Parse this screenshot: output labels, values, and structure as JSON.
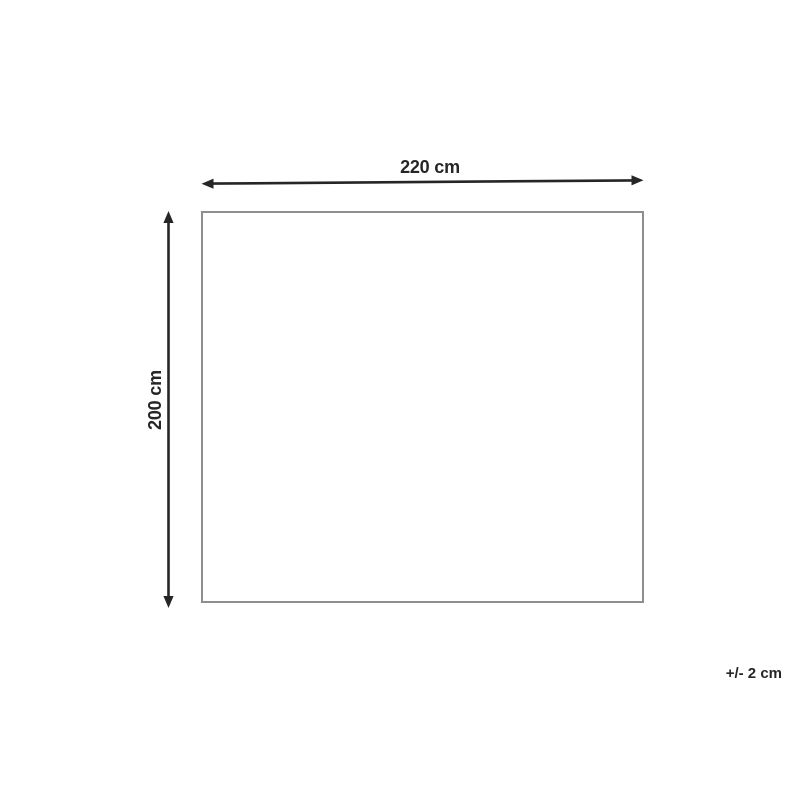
{
  "diagram": {
    "type": "product-dimensions",
    "width_label": "220 cm",
    "height_label": "200 cm",
    "tolerance_label": "+/- 2 cm"
  },
  "colors": {
    "text": "#262626",
    "arrow": "#262626",
    "outline": "#8e8e8e",
    "background": "#ffffff"
  }
}
